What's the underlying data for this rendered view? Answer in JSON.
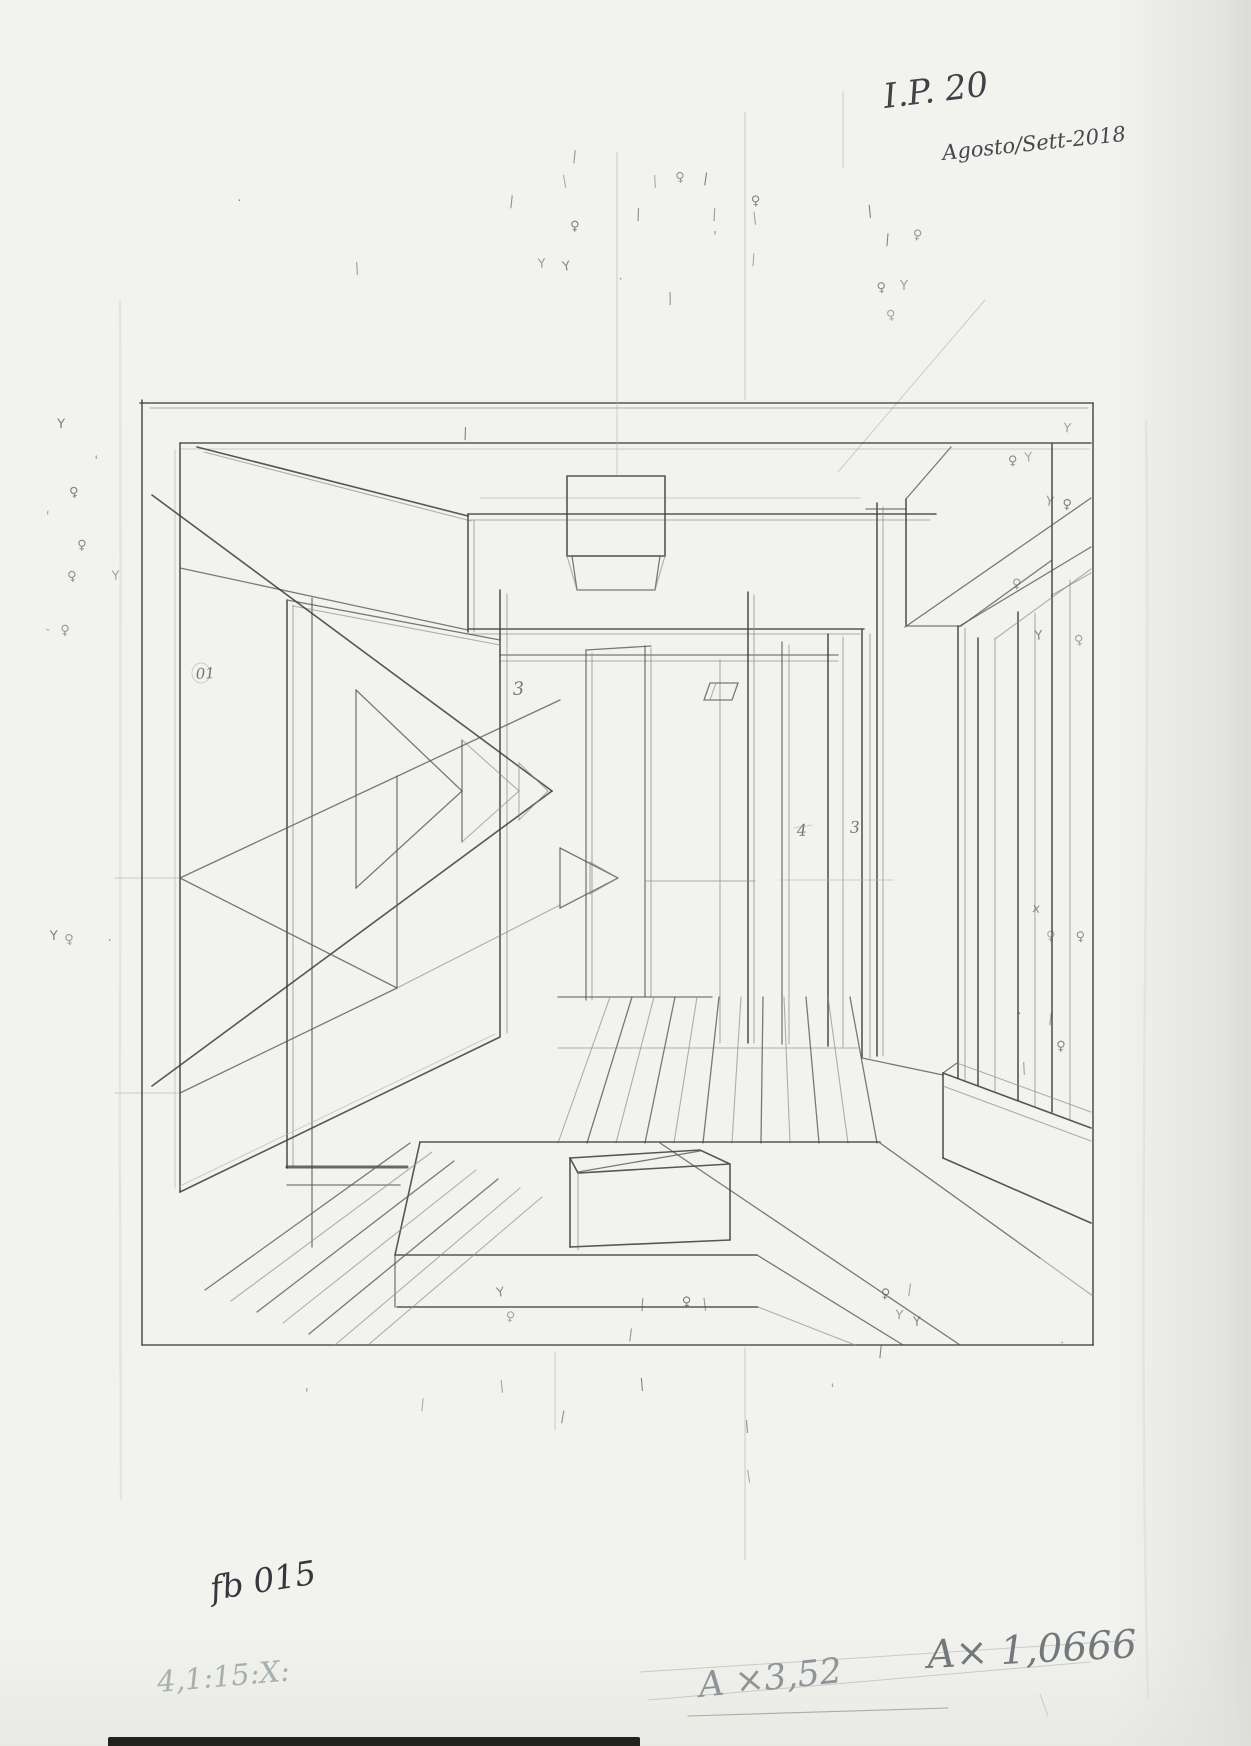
{
  "document": {
    "kind": "scanned hand-drawn one-point perspective interior study",
    "paper_color": "#f2f2ee",
    "pencil_dark": "#43413c",
    "pencil_medium": "#5a5750",
    "pencil_light": "#8b8a83",
    "pencil_faint": "#b0b3ad"
  },
  "annotations": {
    "top_right_code": {
      "text": "I.P. 20",
      "x": 885,
      "y": 108,
      "size": 34,
      "rot": -7,
      "color": "#3f4246"
    },
    "top_right_date": {
      "text": "Agosto/Sett-2018",
      "x": 943,
      "y": 160,
      "size": 21,
      "rot": -6,
      "color": "#44474b"
    },
    "bottom_left_code": {
      "text": "fb 015",
      "x": 212,
      "y": 1600,
      "size": 33,
      "rot": -9,
      "color": "#34373b"
    },
    "bottom_left_ratio": {
      "text": "4,1:15:X:",
      "x": 158,
      "y": 1692,
      "size": 29,
      "rot": -5,
      "color": "#a6afb1"
    },
    "bottom_center_crossed": {
      "text": "A ×3,52",
      "x": 700,
      "y": 1697,
      "size": 35,
      "rot": -6,
      "color": "#8e9599",
      "strikethrough": true
    },
    "bottom_right_scale": {
      "text": "A× 1,0666",
      "x": 928,
      "y": 1668,
      "size": 39,
      "rot": -3,
      "color": "#73787c"
    }
  },
  "figure_labels": [
    {
      "text": "01",
      "x": 196,
      "y": 679,
      "size": 15
    },
    {
      "text": "3",
      "x": 513,
      "y": 695,
      "size": 18
    },
    {
      "text": "4",
      "x": 797,
      "y": 836,
      "size": 16
    },
    {
      "text": "3",
      "x": 850,
      "y": 833,
      "size": 16
    }
  ],
  "mark_glyphs": {
    "y-mark": "Y",
    "female-mark": "♀",
    "tick-mark": "|",
    "dot-mark": "·",
    "stroke-mark": "'",
    "x-mark": "x",
    "dash-mark": "-"
  },
  "marks": [
    [
      "tick-mark",
      563,
      185
    ],
    [
      "tick-mark",
      572,
      160
    ],
    [
      "female-mark",
      570,
      230
    ],
    [
      "y-mark",
      538,
      268
    ],
    [
      "y-mark",
      563,
      271
    ],
    [
      "dot-mark",
      618,
      283
    ],
    [
      "tick-mark",
      636,
      218
    ],
    [
      "tick-mark",
      653,
      185
    ],
    [
      "female-mark",
      676,
      182
    ],
    [
      "tick-mark",
      703,
      182
    ],
    [
      "tick-mark",
      712,
      218
    ],
    [
      "female-mark",
      751,
      205
    ],
    [
      "tick-mark",
      753,
      222
    ],
    [
      "stroke-mark",
      712,
      240
    ],
    [
      "tick-mark",
      751,
      263
    ],
    [
      "tick-mark",
      668,
      302
    ],
    [
      "tick-mark",
      868,
      215
    ],
    [
      "female-mark",
      912,
      238
    ],
    [
      "tick-mark",
      885,
      243
    ],
    [
      "y-mark",
      900,
      290
    ],
    [
      "female-mark",
      877,
      292
    ],
    [
      "female-mark",
      887,
      320
    ],
    [
      "tick-mark",
      509,
      205
    ],
    [
      "y-mark",
      57,
      428
    ],
    [
      "stroke-mark",
      95,
      465
    ],
    [
      "female-mark",
      70,
      497
    ],
    [
      "stroke-mark",
      45,
      520
    ],
    [
      "female-mark",
      77,
      549
    ],
    [
      "y-mark",
      112,
      580
    ],
    [
      "female-mark",
      68,
      581
    ],
    [
      "dash-mark",
      45,
      633
    ],
    [
      "female-mark",
      60,
      634
    ],
    [
      "y-mark",
      50,
      940
    ],
    [
      "female-mark",
      65,
      944
    ],
    [
      "dot-mark",
      107,
      944
    ],
    [
      "y-mark",
      1063,
      432
    ],
    [
      "female-mark",
      1008,
      465
    ],
    [
      "y-mark",
      1025,
      462
    ],
    [
      "y-mark",
      1045,
      505
    ],
    [
      "female-mark",
      1062,
      508
    ],
    [
      "female-mark",
      1012,
      588
    ],
    [
      "y-mark",
      1035,
      640
    ],
    [
      "female-mark",
      1075,
      645
    ],
    [
      "x-mark",
      1032,
      912
    ],
    [
      "female-mark",
      1046,
      940
    ],
    [
      "female-mark",
      1076,
      941
    ],
    [
      "dot-mark",
      1018,
      1018
    ],
    [
      "tick-mark",
      1048,
      1022
    ],
    [
      "female-mark",
      1056,
      1050
    ],
    [
      "tick-mark",
      1022,
      1072
    ],
    [
      "y-mark",
      497,
      1297
    ],
    [
      "female-mark",
      505,
      1320
    ],
    [
      "tick-mark",
      640,
      1308
    ],
    [
      "female-mark",
      682,
      1306
    ],
    [
      "tick-mark",
      703,
      1308
    ],
    [
      "female-mark",
      880,
      1297
    ],
    [
      "y-mark",
      895,
      1319
    ],
    [
      "y-mark",
      913,
      1326
    ],
    [
      "tick-mark",
      500,
      1390
    ],
    [
      "tick-mark",
      560,
      1420
    ],
    [
      "tick-mark",
      420,
      1408
    ],
    [
      "stroke-mark",
      305,
      1398
    ],
    [
      "tick-mark",
      640,
      1388
    ],
    [
      "stroke-mark",
      832,
      1393
    ],
    [
      "tick-mark",
      878,
      1355
    ],
    [
      "dot-mark",
      1060,
      1347
    ],
    [
      "tick-mark",
      745,
      1430
    ],
    [
      "tick-mark",
      747,
      1480
    ],
    [
      "tick-mark",
      628,
      1338
    ],
    [
      "tick-mark",
      463,
      437
    ],
    [
      "tick-mark",
      355,
      272
    ],
    [
      "dot-mark",
      238,
      205
    ],
    [
      "tick-mark",
      907,
      1293
    ]
  ]
}
